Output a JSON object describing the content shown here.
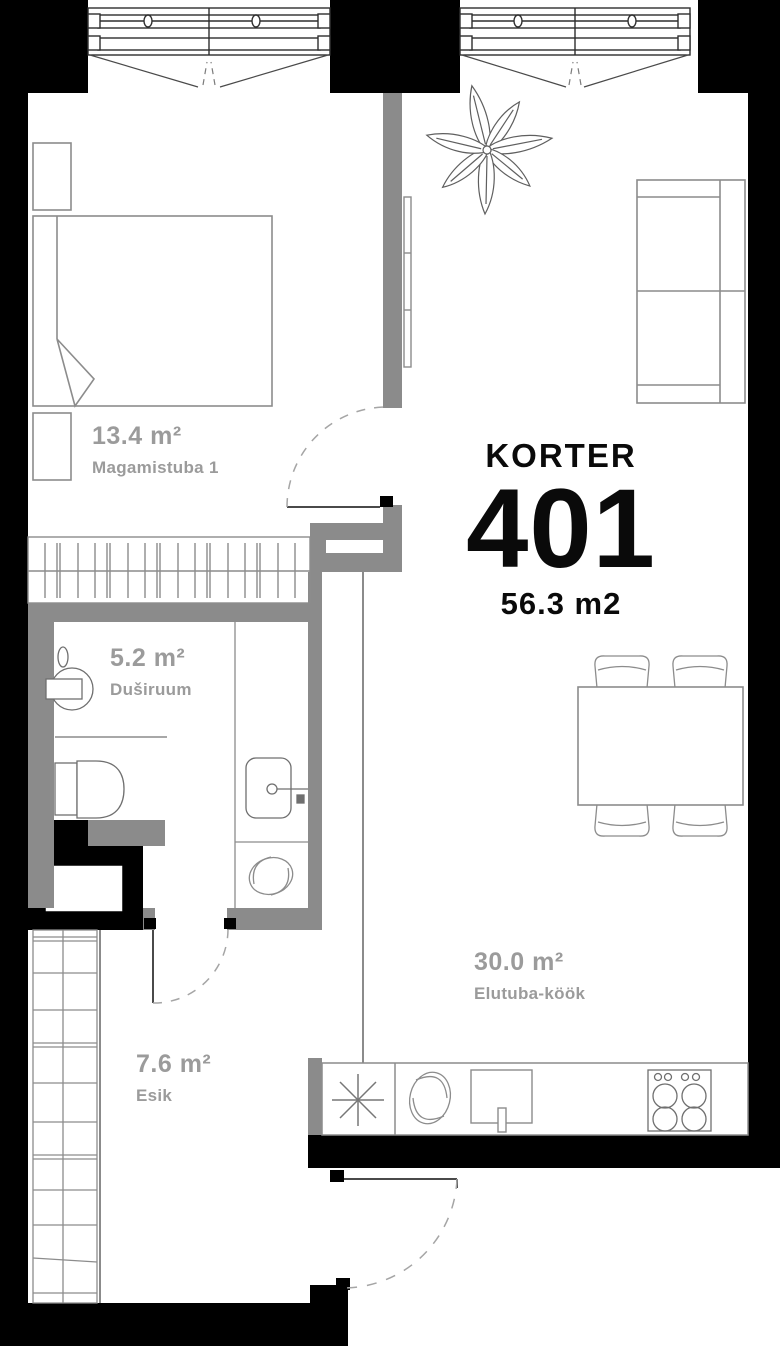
{
  "apartment": {
    "label": "KORTER",
    "number": "401",
    "total_area": "56.3 m2"
  },
  "rooms": [
    {
      "key": "bedroom",
      "area": "13.4 m²",
      "name": "Magamistuba 1",
      "fixtures": [
        "bed",
        "nightstand",
        "nightstand",
        "closet-rail",
        "tv"
      ]
    },
    {
      "key": "bathroom",
      "area": "5.2 m²",
      "name": "Duširuum",
      "fixtures": [
        "shower",
        "toilet",
        "washbasin",
        "washing-machine"
      ]
    },
    {
      "key": "hallway",
      "area": "7.6 m²",
      "name": "Esik",
      "fixtures": [
        "wardrobe-shelves"
      ]
    },
    {
      "key": "living-kitchen",
      "area": "30.0 m²",
      "name": "Elutuba-köök",
      "fixtures": [
        "plant",
        "sofa",
        "dining-table",
        "chair",
        "chair",
        "chair",
        "chair",
        "kitchen-counter",
        "fridge",
        "sink-bowl",
        "kitchen-sink",
        "stove"
      ]
    }
  ],
  "colors": {
    "exterior_wall": "#000000",
    "interior_wall": "#8b8b8b",
    "furniture_line": "#8c8c8c",
    "room_label": "#9b9b9b",
    "title": "#0a0a0a"
  }
}
